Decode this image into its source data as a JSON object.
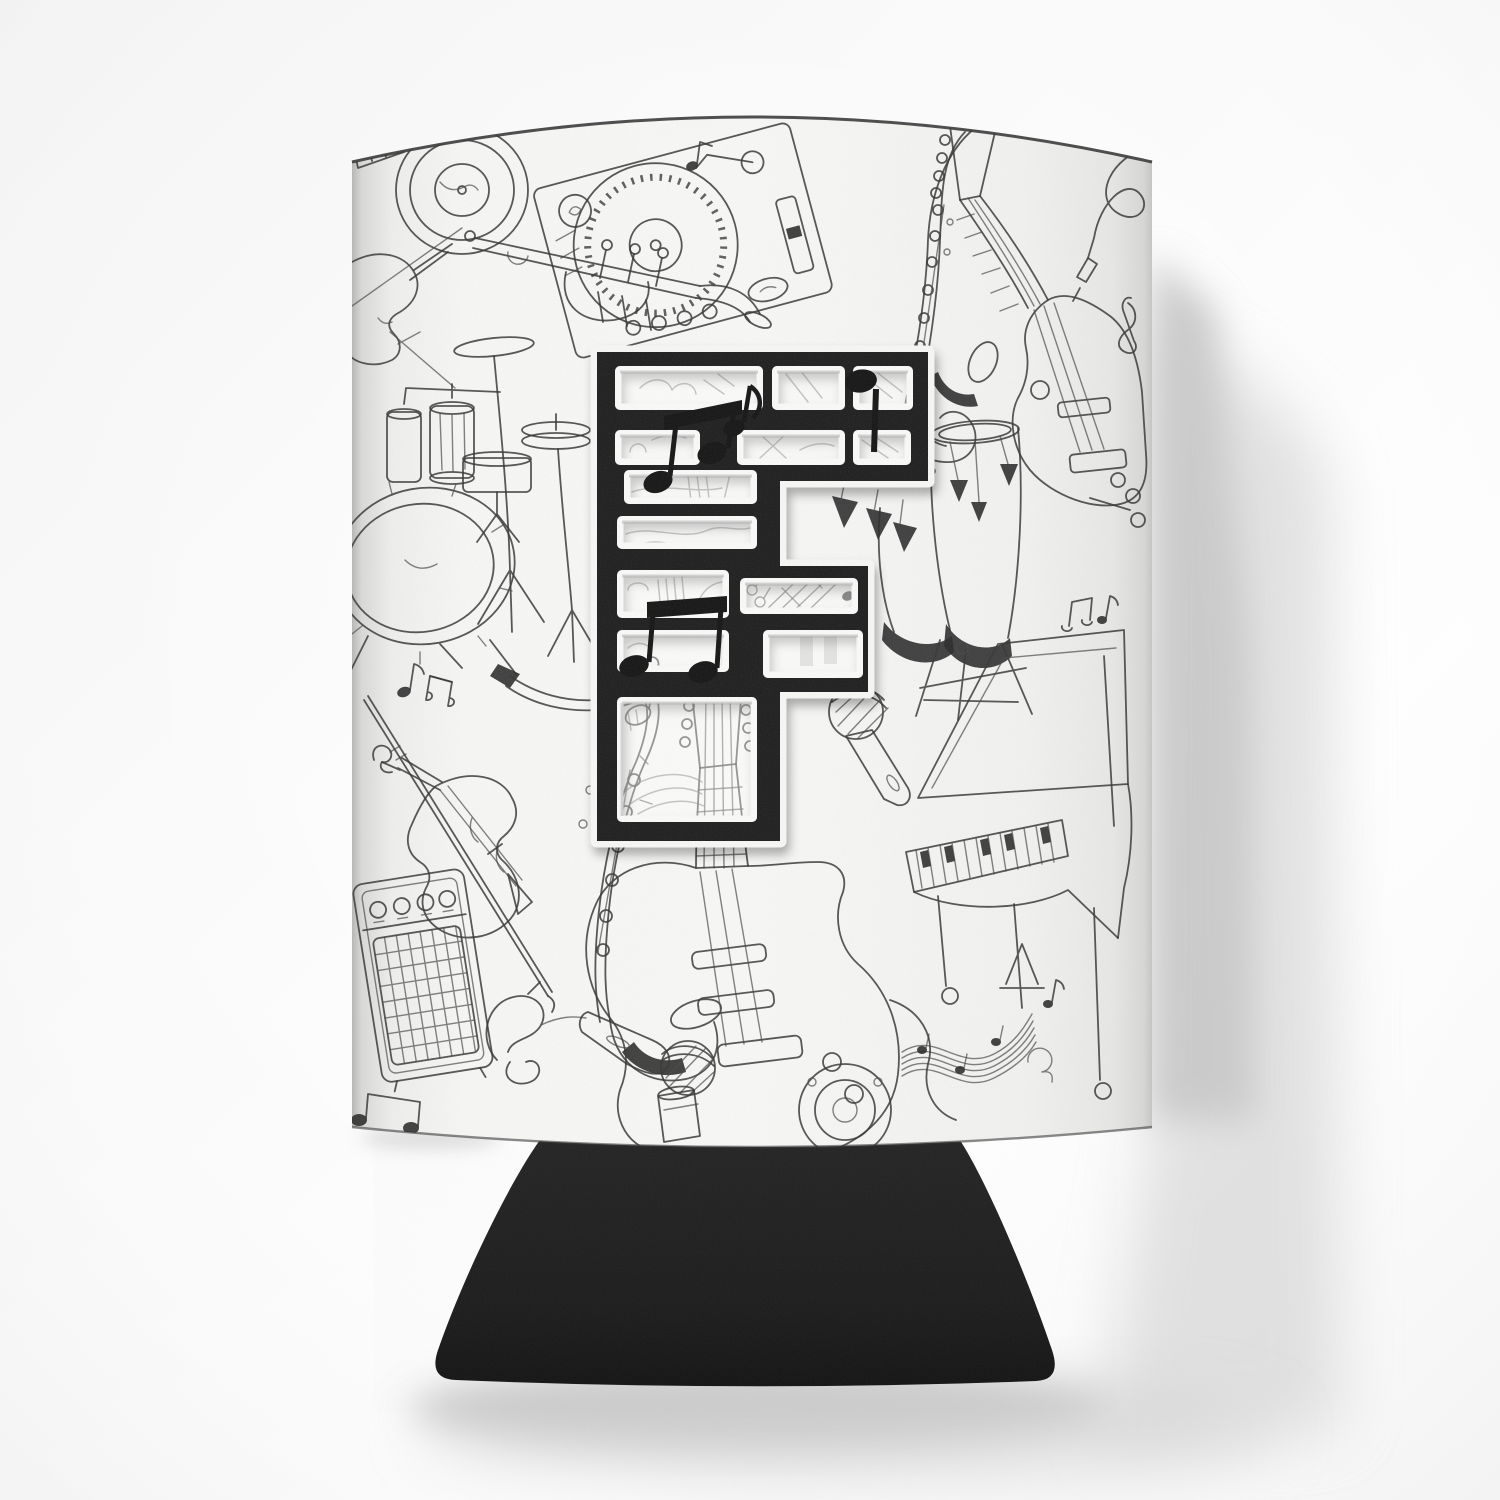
{
  "meta": {
    "type": "product-photograph",
    "description": "White fabric can cooler (koozie) printed with black hand-drawn music doodles — vinyl record, DJ turntable, saxophones, guitars, violin, trumpet, drum kit, congas, grand piano, amplifier and microphones — with a large black stencil monogram letter F made of musical notes, a black flared fabric base, photographed on a light studio background with soft shadows cast to the right and below."
  },
  "monogram": {
    "letter": "F",
    "style": "black brick-stencil tile with white rim and musical notes",
    "notes": [
      "beamed-eighth-note-pair",
      "eighth-note-with-flag",
      "quarter-note",
      "large-beamed-eighth-note-pair",
      "outline-eighth-note"
    ]
  },
  "palette": {
    "background": "#f7f7f7",
    "fabric_white": "#f3f3f1",
    "doodle_ink": "#383838",
    "tile_black": "#212121",
    "base_black": "#1e1e1e",
    "rim_white": "#f6f6f4",
    "shadow": "#c0c0c0"
  },
  "doodles": [
    {
      "name": "piano-keys-corner"
    },
    {
      "name": "vinyl-record"
    },
    {
      "name": "dj-turntable"
    },
    {
      "name": "violin-upper-left"
    },
    {
      "name": "trumpet"
    },
    {
      "name": "saxophone-upper"
    },
    {
      "name": "electric-guitar-upper-right"
    },
    {
      "name": "instrument-cable"
    },
    {
      "name": "treble-clef"
    },
    {
      "name": "drum-kit"
    },
    {
      "name": "hi-hat"
    },
    {
      "name": "conga-drums"
    },
    {
      "name": "microphone-center"
    },
    {
      "name": "grand-piano"
    },
    {
      "name": "sheet-music-ribbon"
    },
    {
      "name": "violin-lower-left"
    },
    {
      "name": "saxophone-lower"
    },
    {
      "name": "guitar-amplifier"
    },
    {
      "name": "microphone-lower"
    },
    {
      "name": "electric-guitar-center"
    },
    {
      "name": "speaker"
    },
    {
      "name": "shaker"
    },
    {
      "name": "scattered-music-notes"
    }
  ]
}
